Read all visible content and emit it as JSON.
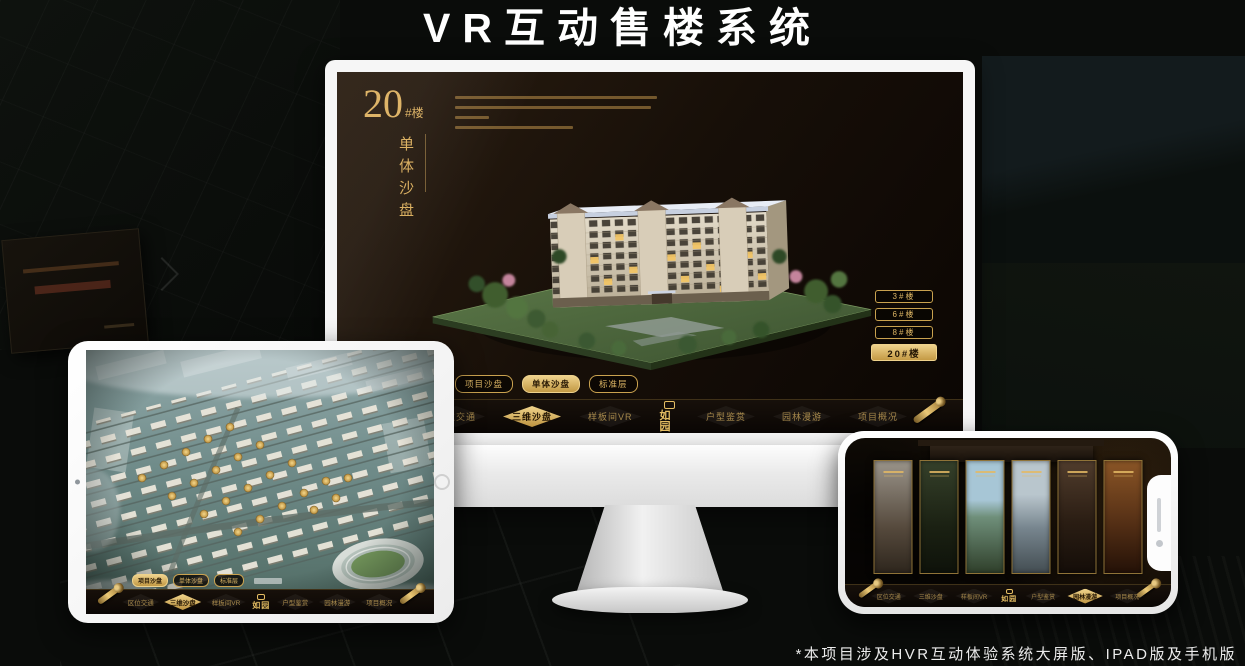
{
  "page": {
    "title": "VR互动售楼系统",
    "footnote": "*本项目涉及HVR互动体验系统大屏版、IPAD版及手机版"
  },
  "brand": {
    "logo_text": "如园"
  },
  "colors": {
    "gold": "#c9a24f",
    "gold_bright": "#eed28c",
    "screen_bg": "#170f08",
    "device_shell": "#f6f6f6"
  },
  "monitor": {
    "block_number": "20",
    "block_number_suffix": "#楼",
    "block_subtitle": "单体沙盘",
    "floor_buttons": [
      {
        "label": "3#楼",
        "active": false
      },
      {
        "label": "6#楼",
        "active": false
      },
      {
        "label": "8#楼",
        "active": false
      },
      {
        "label": "20#楼",
        "active": true
      }
    ],
    "tabs": [
      {
        "label": "项目沙盘",
        "active": false
      },
      {
        "label": "单体沙盘",
        "active": true
      },
      {
        "label": "标准层",
        "active": false
      }
    ],
    "menu": [
      {
        "label": "区位交通",
        "active": false
      },
      {
        "label": "三维沙盘",
        "active": true
      },
      {
        "label": "样板间VR",
        "active": false
      },
      {
        "label": "户型鉴赏",
        "active": false
      },
      {
        "label": "园林漫游",
        "active": false
      },
      {
        "label": "项目概况",
        "active": false
      }
    ]
  },
  "ipad": {
    "tabs": [
      {
        "label": "项目沙盘",
        "active": true
      },
      {
        "label": "单体沙盘",
        "active": false
      },
      {
        "label": "标准层",
        "active": false
      }
    ],
    "menu": [
      {
        "label": "区位交通",
        "active": false
      },
      {
        "label": "三维沙盘",
        "active": true
      },
      {
        "label": "样板间VR",
        "active": false
      },
      {
        "label": "户型鉴赏",
        "active": false
      },
      {
        "label": "园林漫游",
        "active": false
      },
      {
        "label": "项目概况",
        "active": false
      }
    ]
  },
  "phone": {
    "menu": [
      {
        "label": "区位交通",
        "active": false
      },
      {
        "label": "三维沙盘",
        "active": false
      },
      {
        "label": "样板间VR",
        "active": false
      },
      {
        "label": "户型鉴赏",
        "active": false
      },
      {
        "label": "园林漫游",
        "active": true
      },
      {
        "label": "项目概况",
        "active": false
      }
    ]
  }
}
